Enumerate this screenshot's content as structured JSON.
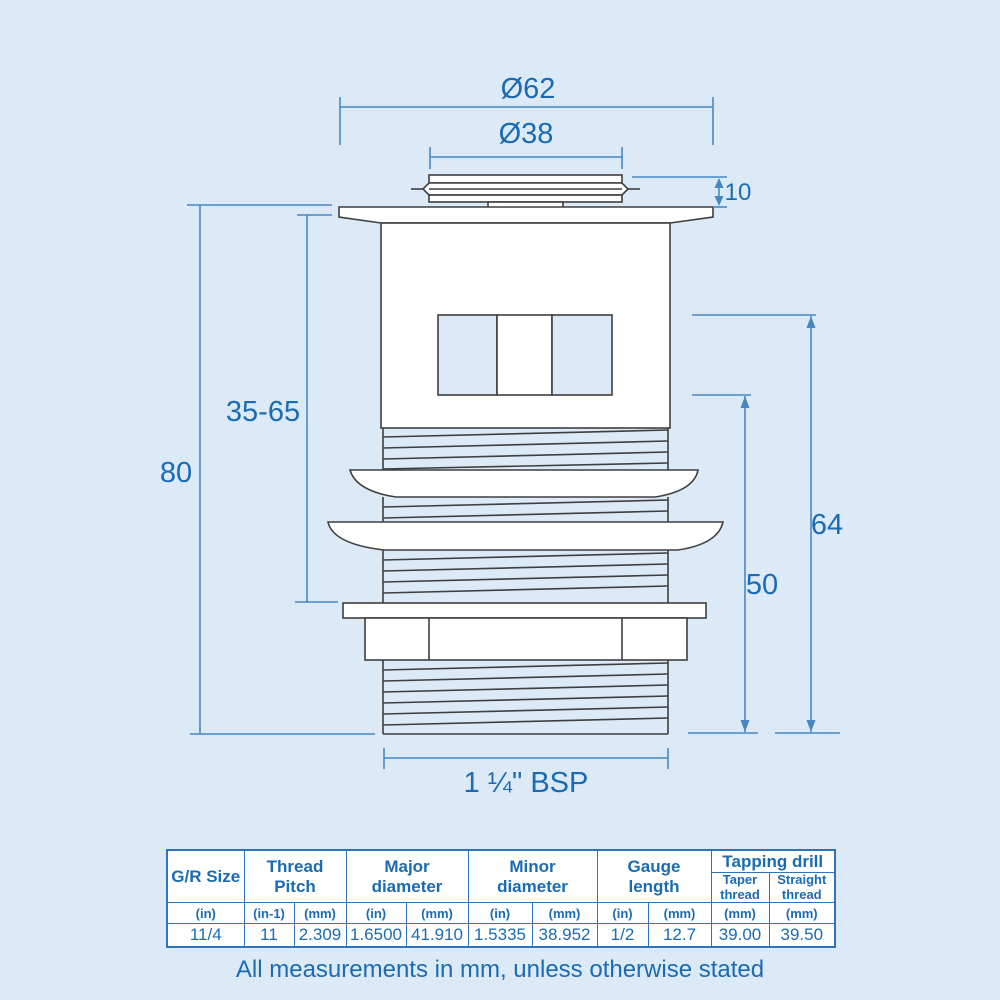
{
  "colors": {
    "background": "#dce9f6",
    "accent_text": "#1a6bb3",
    "dimension_lines": "#4688c4",
    "table_border": "#2f74b9",
    "drawing_outline": "#3f3f3f"
  },
  "diagram": {
    "dim_outer_diameter": "Ø62",
    "dim_inner_diameter": "Ø38",
    "dim_cap_height": "10",
    "dim_overall_length": "80",
    "dim_adjustable_range": "35-65",
    "dim_right_outer": "64",
    "dim_right_inner": "50",
    "dim_thread_spec": "1 ¼\" BSP"
  },
  "table": {
    "groups": [
      {
        "label": "G/R Size"
      },
      {
        "label": "Thread\nPitch"
      },
      {
        "label": "Major\ndiameter"
      },
      {
        "label": "Minor\ndiameter"
      },
      {
        "label": "Gauge\nlength"
      },
      {
        "label": "Tapping drill",
        "subs": [
          "Taper\nthread",
          "Straight\nthread"
        ]
      }
    ],
    "units": [
      "(in)",
      "(in-1)",
      "(mm)",
      "(in)",
      "(mm)",
      "(in)",
      "(mm)",
      "(in)",
      "(mm)",
      "(mm)",
      "(mm)"
    ],
    "values": [
      "11/4",
      "11",
      "2.309",
      "1.6500",
      "41.910",
      "1.5335",
      "38.952",
      "1/2",
      "12.7",
      "39.00",
      "39.50"
    ]
  },
  "footer": {
    "note": "All measurements in mm, unless otherwise stated"
  }
}
